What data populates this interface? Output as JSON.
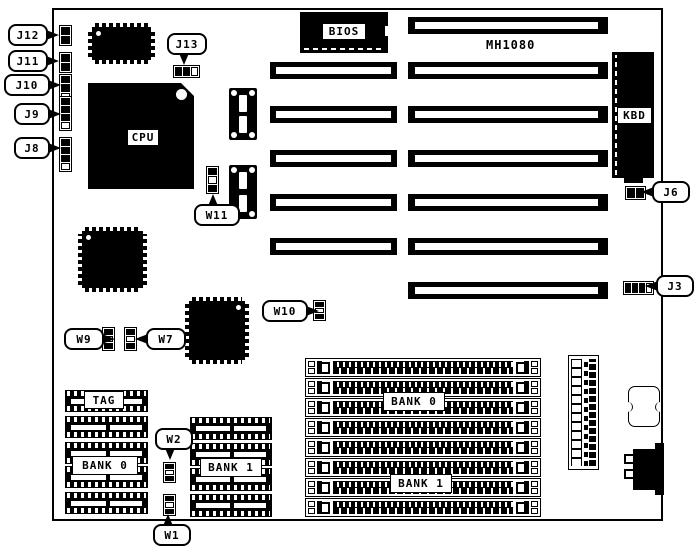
{
  "board": {
    "model": "MH1080"
  },
  "labels": {
    "cpu": "CPU",
    "bios": "BIOS",
    "kbd": "KBD",
    "tag": "TAG",
    "cache_bank0": "BANK 0",
    "cache_bank1": "BANK 1",
    "simm_bank0": "BANK 0",
    "simm_bank1": "BANK 1"
  },
  "callouts": {
    "j12": "J12",
    "j11": "J11",
    "j10": "J10",
    "j9": "J9",
    "j8": "J8",
    "j13": "J13",
    "j6": "J6",
    "j3": "J3",
    "w11": "W11",
    "w10": "W10",
    "w9": "W9",
    "w7": "W7",
    "w2": "W2",
    "w1": "W1"
  }
}
